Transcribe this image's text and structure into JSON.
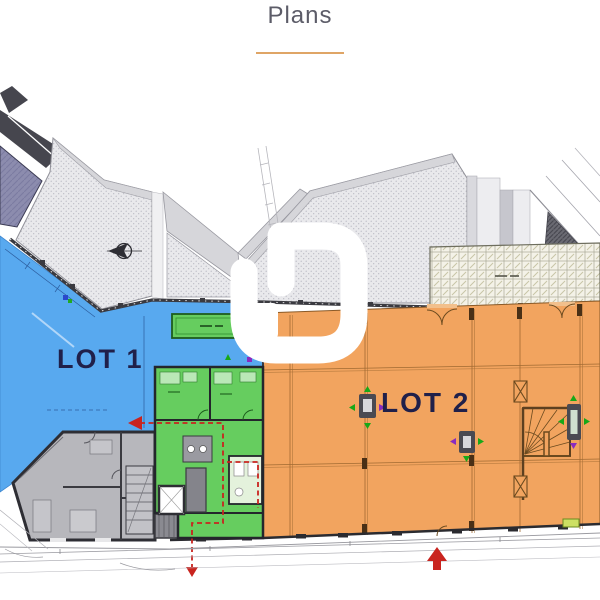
{
  "header": {
    "title": "Plans"
  },
  "plan": {
    "lot1_label": "LOT 1",
    "lot2_label": "LOT 2",
    "colors": {
      "lot1": "#58a9ef",
      "lot2": "#f2a45f",
      "common": "#66cd5f",
      "underline": "#dfa566",
      "route": "#c9241f",
      "label": "#20204a",
      "purple": "#8c8cae",
      "terrace": "#e9e9ec",
      "wall": "#35353c"
    },
    "icons": {
      "north_compass": "compass-icon",
      "watermark": "watermark-logo",
      "entrance": "arrow-up-icon",
      "evacuation": "arrow-left-icon"
    }
  }
}
